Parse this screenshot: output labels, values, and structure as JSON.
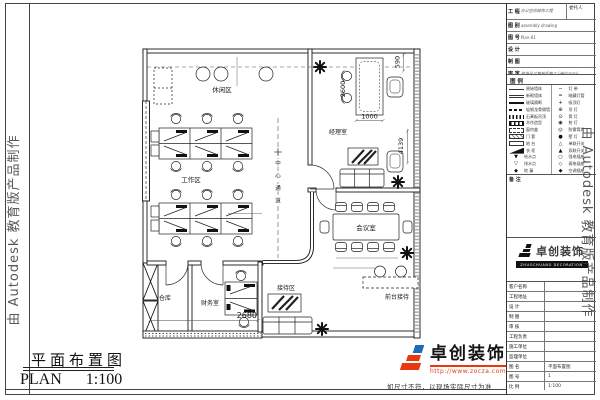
{
  "watermark": {
    "text": "由 Autodesk 教育版产品制作"
  },
  "plan": {
    "rooms": {
      "leisure": "休闲区",
      "work": "工作区",
      "manager": "经理室",
      "meeting": "会议室",
      "finance": "财务室",
      "storage": "仓库",
      "reception": "接待区",
      "front_desk": "前台接待",
      "corridor": [
        "中",
        "心",
        "通",
        "道"
      ]
    },
    "dims": {
      "right_top": "590",
      "desk_height": "2600",
      "desk_width": "1000",
      "window": "4139",
      "finance_width": "2680"
    }
  },
  "titleblock": {
    "field1": {
      "label": "工 程",
      "value": "办公空间装饰工程",
      "right": "委托人"
    },
    "fields": [
      {
        "label": "图 别",
        "value": "assembly drawing"
      },
      {
        "label": "图 号",
        "value": "Plan-01"
      },
      {
        "label": "设 计",
        "value": ""
      },
      {
        "label": "制 图",
        "value": ""
      },
      {
        "label": "审 定",
        "value": "现场尺寸复核后施工 (单位:mm)"
      }
    ],
    "legend_title": "图 例",
    "legend_left": [
      {
        "sw": "line-thin",
        "label": "原始墙体"
      },
      {
        "sw": "line-double",
        "label": "新砌墙体"
      },
      {
        "sw": "line-thick",
        "label": "玻璃隔断"
      },
      {
        "sw": "line-dash",
        "label": "轻钢龙骨隔墙"
      },
      {
        "sw": "line-hatch",
        "label": "石膏板吊顶"
      },
      {
        "sw": "box-grid",
        "label": "木作造型"
      },
      {
        "sw": "box-dash",
        "label": "窗帘盒"
      },
      {
        "sw": "box-hatch",
        "label": "门 套"
      },
      {
        "sw": "box-empty",
        "label": "地 台"
      },
      {
        "sw": "wedge",
        "label": "衣 柜"
      },
      {
        "gl": "▼",
        "label": "给水点"
      },
      {
        "gl": "▽",
        "label": "排水点"
      },
      {
        "gl": "◆",
        "label": "地 漏"
      }
    ],
    "legend_right": [
      {
        "gl": "─",
        "label": "灯 带"
      },
      {
        "gl": "═",
        "label": "暗藏灯管"
      },
      {
        "gl": "+",
        "label": "吸顶灯"
      },
      {
        "gl": "⊕",
        "label": "吊 灯"
      },
      {
        "gl": "⊙",
        "label": "筒 灯"
      },
      {
        "gl": "◉",
        "label": "射 灯"
      },
      {
        "gl": "◎",
        "label": "防雾筒灯"
      },
      {
        "gl": "●",
        "label": "壁 灯"
      },
      {
        "gl": "△",
        "label": "单联开关"
      },
      {
        "gl": "▲",
        "label": "双联开关"
      },
      {
        "gl": "○",
        "label": "强电插座"
      },
      {
        "gl": "◇",
        "label": "弱电插座"
      },
      {
        "gl": "◆",
        "label": "空调插座"
      }
    ],
    "notes_title": "备 注",
    "notes": [
      "1、图中尺寸均以毫米为单位。",
      "2、施工时如与现场不符，请及时与设计师联系。",
      "3、隐蔽工程须验收合格后方可进行下道工序。",
      "4、未尽事宜参照国家现行规范执行。"
    ],
    "logo": {
      "name": "卓创装饰",
      "sub": "ZHUOCHUANG DECORATION"
    },
    "rows": [
      {
        "label": "客户名称",
        "value": ""
      },
      {
        "label": "工程地址",
        "value": ""
      },
      {
        "label": "设 计",
        "value": ""
      },
      {
        "label": "制 图",
        "value": ""
      },
      {
        "label": "审 核",
        "value": ""
      },
      {
        "label": "工程负责",
        "value": ""
      },
      {
        "label": "施工单位",
        "value": ""
      },
      {
        "label": "监理单位",
        "value": ""
      },
      {
        "label": "图 名",
        "value": "平面布置图"
      },
      {
        "label": "图 号",
        "value": "1"
      },
      {
        "label": "比 例",
        "value": "1:100"
      },
      {
        "label": "日 期",
        "value": "2007.08"
      }
    ]
  },
  "footer": {
    "title_cn": "平面布置图",
    "title_en": "PLAN",
    "scale": "1:100",
    "note": "如尺寸不符，以现场实际尺寸为准",
    "logo_name": "卓创装饰",
    "logo_url": "http://www.zocza.com"
  },
  "colors": {
    "accent_red": "#e8380d",
    "accent_blue": "#1e6bb8",
    "line": "#1a1a1a"
  }
}
